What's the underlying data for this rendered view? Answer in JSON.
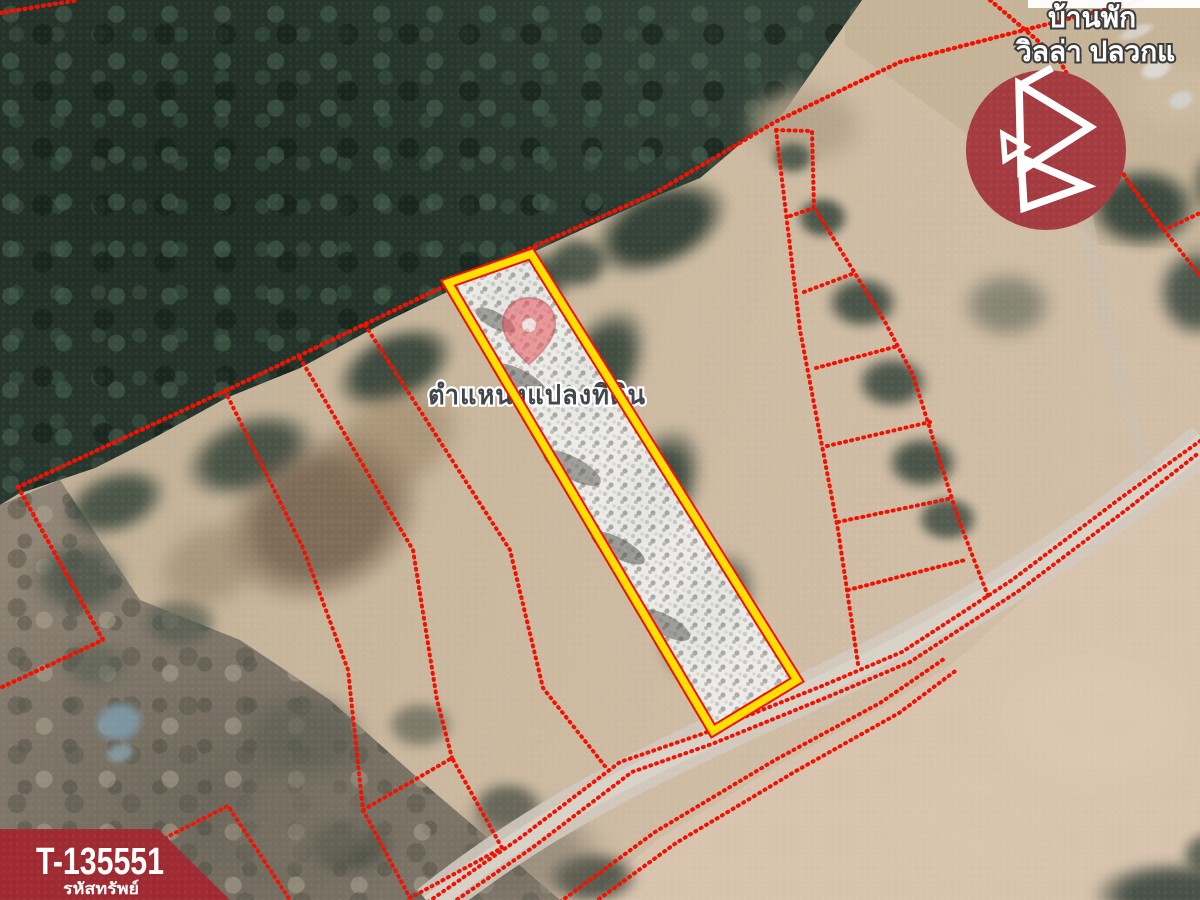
{
  "map": {
    "parcel_label": "ตำแหน่งแปลงที่ดิน",
    "place_line1": "บ้านพัก",
    "place_line2": "วิลล่า ปลวกแ",
    "marker": "location-pin-icon"
  },
  "badge": {
    "code": "T-135551",
    "caption": "รหัสทรัพย์"
  },
  "logo": {
    "icon": "triangle-b-logo-icon"
  },
  "colors": {
    "line": "#f21000",
    "highlight": "#ffdf00",
    "logo": "#a43b40",
    "badge": "#a02a31",
    "road": "#d1c9be",
    "forest": "#2c3b32",
    "field": "#c8b49a"
  }
}
